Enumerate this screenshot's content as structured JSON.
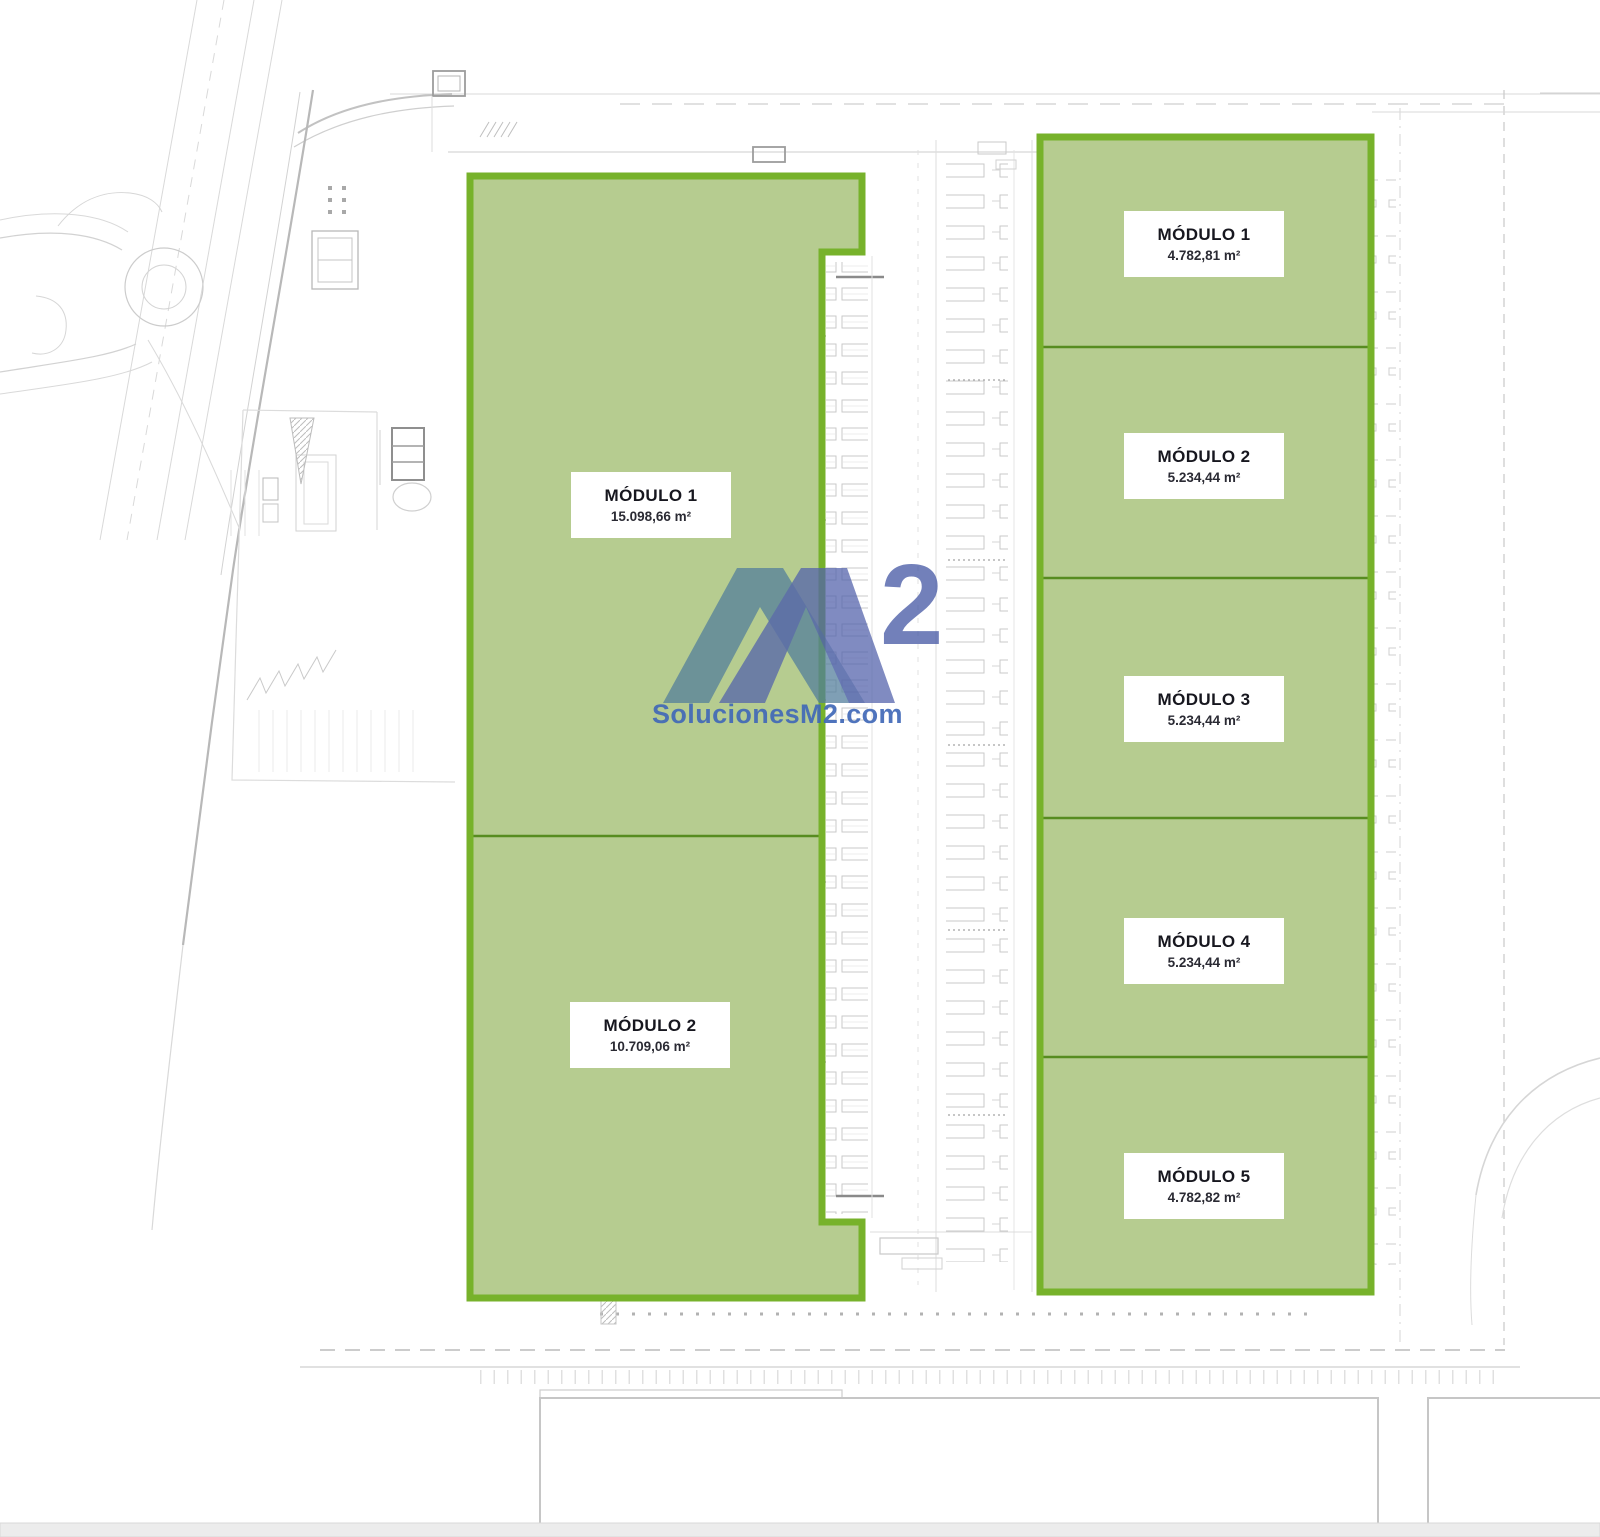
{
  "plan": {
    "left_building": {
      "modules": [
        {
          "name": "MÓDULO 1",
          "area": "15.098,66 m²"
        },
        {
          "name": "MÓDULO 2",
          "area": "10.709,06 m²"
        }
      ]
    },
    "right_building": {
      "modules": [
        {
          "name": "MÓDULO 1",
          "area": "4.782,81 m²"
        },
        {
          "name": "MÓDULO 2",
          "area": "5.234,44 m²"
        },
        {
          "name": "MÓDULO 3",
          "area": "5.234,44 m²"
        },
        {
          "name": "MÓDULO 4",
          "area": "5.234,44 m²"
        },
        {
          "name": "MÓDULO 5",
          "area": "4.782,82 m²"
        }
      ]
    },
    "watermark": {
      "logo_letter": "M",
      "logo_exponent": "2",
      "site_url": "SolucionesM2.com"
    },
    "colors": {
      "module_fill": "#b6cc90",
      "module_border": "#77b22b",
      "module_divider": "#578c20",
      "watermark_teal": "#527e9b",
      "watermark_blue": "#5363ab",
      "watermark_text": "#4169b8",
      "label_text": "#17171f",
      "background_line": "#cfcfcf"
    }
  }
}
